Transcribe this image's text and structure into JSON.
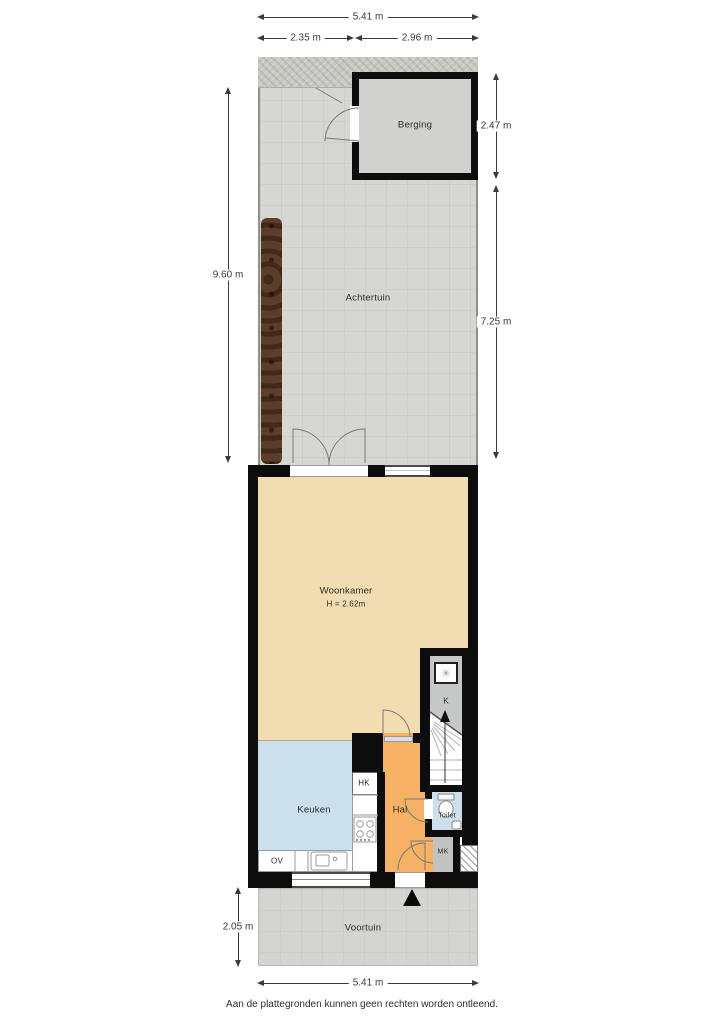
{
  "dimensions": {
    "top_total": "5.41 m",
    "top_left_segment": "2.35 m",
    "top_right_segment": "2.96 m",
    "garden_left": "9.60 m",
    "berging_right": "2.47 m",
    "garden_right": "7.25 m",
    "voortuin_left": "2.05 m",
    "bottom_total": "5.41 m"
  },
  "rooms": {
    "berging": "Berging",
    "achtertuin": "Achtertuin",
    "woonkamer": "Woonkamer",
    "woonkamer_height": "H = 2.62m",
    "keuken": "Keuken",
    "hal": "Hal",
    "toilet": "Toilet",
    "voortuin": "Voortuin",
    "k_closet": "K",
    "hk_closet": "HK",
    "mk_closet": "MK",
    "ov_unit": "OV"
  },
  "icons": {
    "boiler_glyph": "✳"
  },
  "footer": "Aan de plattegronden kunnen geen rechten worden ontleend.",
  "colors": {
    "wall": "#0d0d0d",
    "woonkamer": "#f2dcb2",
    "keuken": "#cbdfed",
    "toilet_room": "#cbdfed",
    "hal": "#f5b264",
    "garden": "#d6d6d3",
    "alley": "#c8c8c3",
    "voortuin": "#d4d4d1",
    "berging": "#d1d1cf",
    "closet_gray": "#c6c7c7",
    "mk_gray": "#c2c2c2",
    "hedge": "#5c3d2a",
    "dim": "#3a3a3a"
  }
}
